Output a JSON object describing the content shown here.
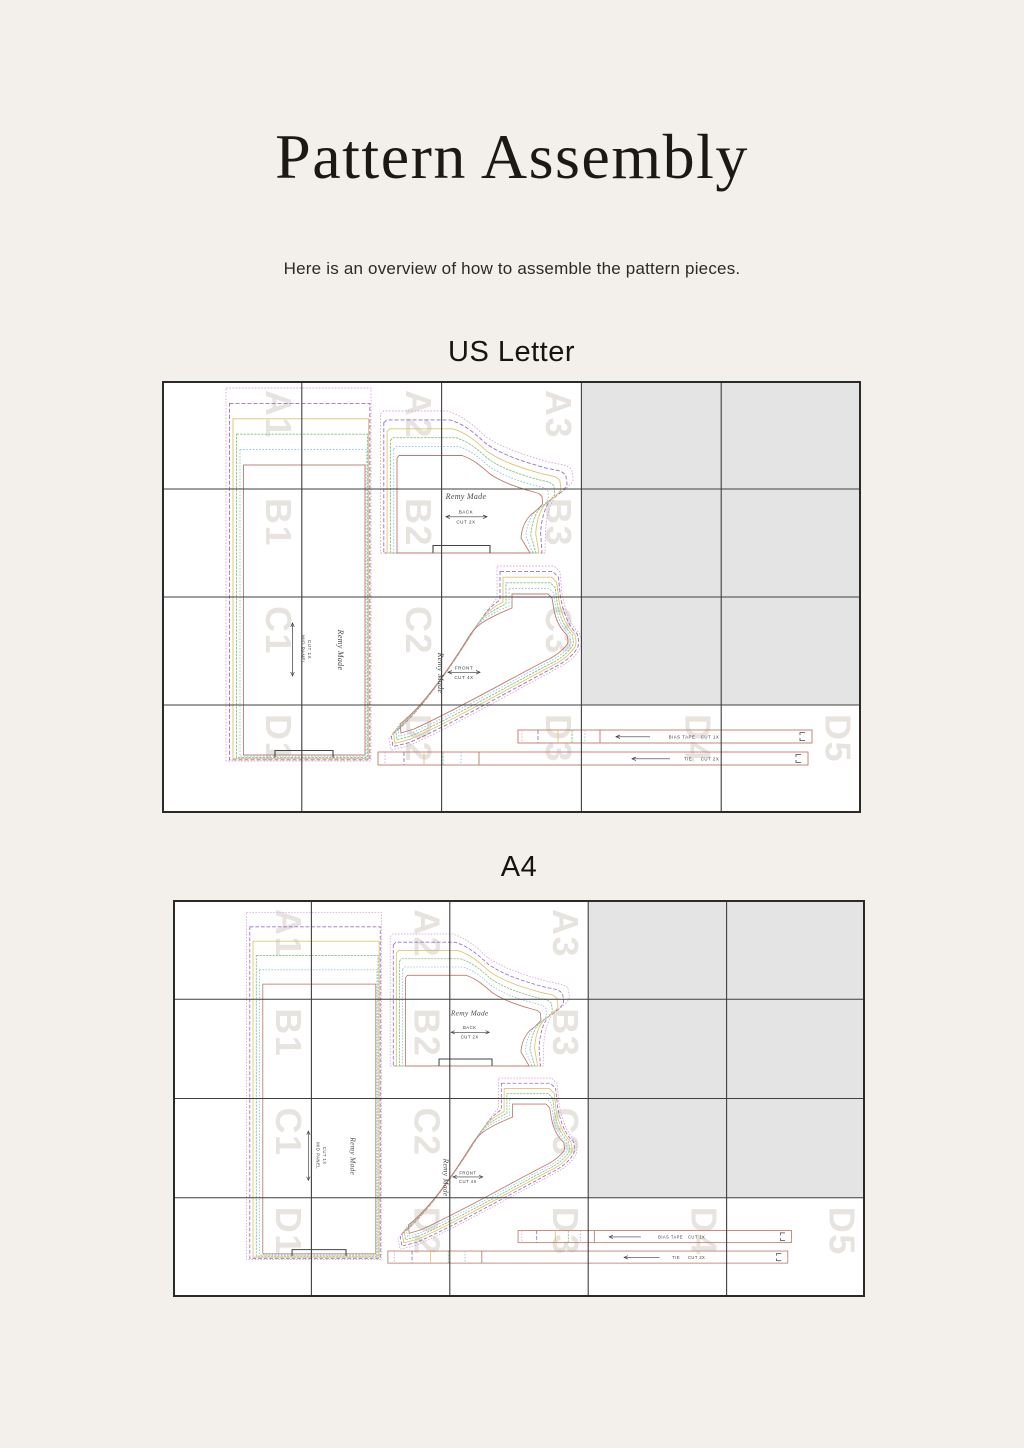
{
  "page": {
    "title": "Pattern Assembly",
    "subtitle": "Here is an overview of how to assemble the pattern pieces."
  },
  "diagrams": [
    {
      "heading": "US Letter",
      "cols": 5,
      "rows": 4
    },
    {
      "heading": "A4",
      "cols": 5,
      "rows": 4
    }
  ],
  "grid": {
    "labeled_cells": [
      [
        "A1",
        "A2",
        "A3",
        null,
        null
      ],
      [
        "B1",
        "B2",
        "B3",
        null,
        null
      ],
      [
        "C1",
        "C2",
        "C3",
        null,
        null
      ],
      [
        "D1",
        "D2",
        "D3",
        "D4",
        "D5"
      ]
    ],
    "unused_cells": [
      "A4",
      "A5",
      "B4",
      "B5",
      "C4",
      "C5"
    ]
  },
  "brand": "Remy Made",
  "pieces": {
    "mid_panel": {
      "name": "MID PANEL",
      "cut": "CUT 1X"
    },
    "back": {
      "name": "BACK",
      "cut": "CUT 2X"
    },
    "front": {
      "name": "FRONT",
      "cut": "CUT 4X"
    },
    "bias_tape": {
      "name": "BIAS TAPE",
      "cut": "CUT 1X"
    },
    "tie": {
      "name": "TIE",
      "cut": "CUT 2X"
    }
  },
  "size_outline_colors": [
    "#d9a7d9",
    "#9b6ec8",
    "#dfc36e",
    "#86c385",
    "#8fc3dc",
    "#bf7a6a"
  ],
  "size_outline_dashes": [
    "1.6,1.6",
    "4,2",
    "",
    "2.5,1",
    "1.6,1.6",
    ""
  ],
  "colors": {
    "background": "#f3f0eb",
    "page_fill": "#ffffff",
    "unused_fill": "#e4e4e4",
    "grid_line": "#3f3f3f",
    "grid_border": "#2a2a2a",
    "watermark": "#e7e4e0",
    "ink": "#3a3a3a",
    "mark": "#444444"
  }
}
